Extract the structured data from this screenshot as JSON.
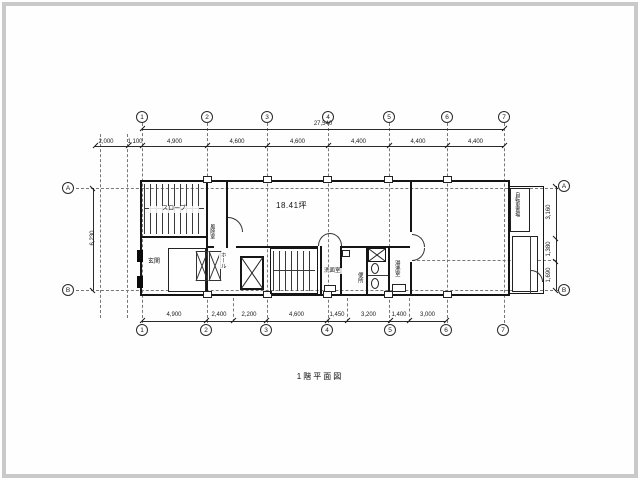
{
  "title": "1階平面図",
  "area_label": "18.41坪",
  "grid": {
    "cols": [
      "1",
      "2",
      "3",
      "4",
      "5",
      "6",
      "7"
    ],
    "rows": [
      "A",
      "B"
    ]
  },
  "dims": {
    "top_overall": "27,540",
    "top_offsets": [
      "2,000",
      "1,100"
    ],
    "top_spans": [
      "4,900",
      "4,600",
      "4,600",
      "4,400",
      "4,400",
      "4,400"
    ],
    "bottom_spans": [
      "4,900",
      "2,400",
      "2,200",
      "4,600",
      "1,450",
      "3,200",
      "1,400",
      "3,000"
    ],
    "left_overall": "6,230",
    "right_spans": [
      "3,160",
      "1,380",
      "1,690"
    ]
  },
  "rooms": {
    "ramp": "スロープ",
    "entrance": "玄関",
    "vestibule": "風除室",
    "hall": "ホール",
    "washroom": "洗面室",
    "toilet": "便所",
    "kitchenette": "湯沸室",
    "bicycle_parking": "自転車置場"
  },
  "colors": {
    "line": "#151515",
    "axis_line": "#777777",
    "frame": "#c9c9c9"
  }
}
